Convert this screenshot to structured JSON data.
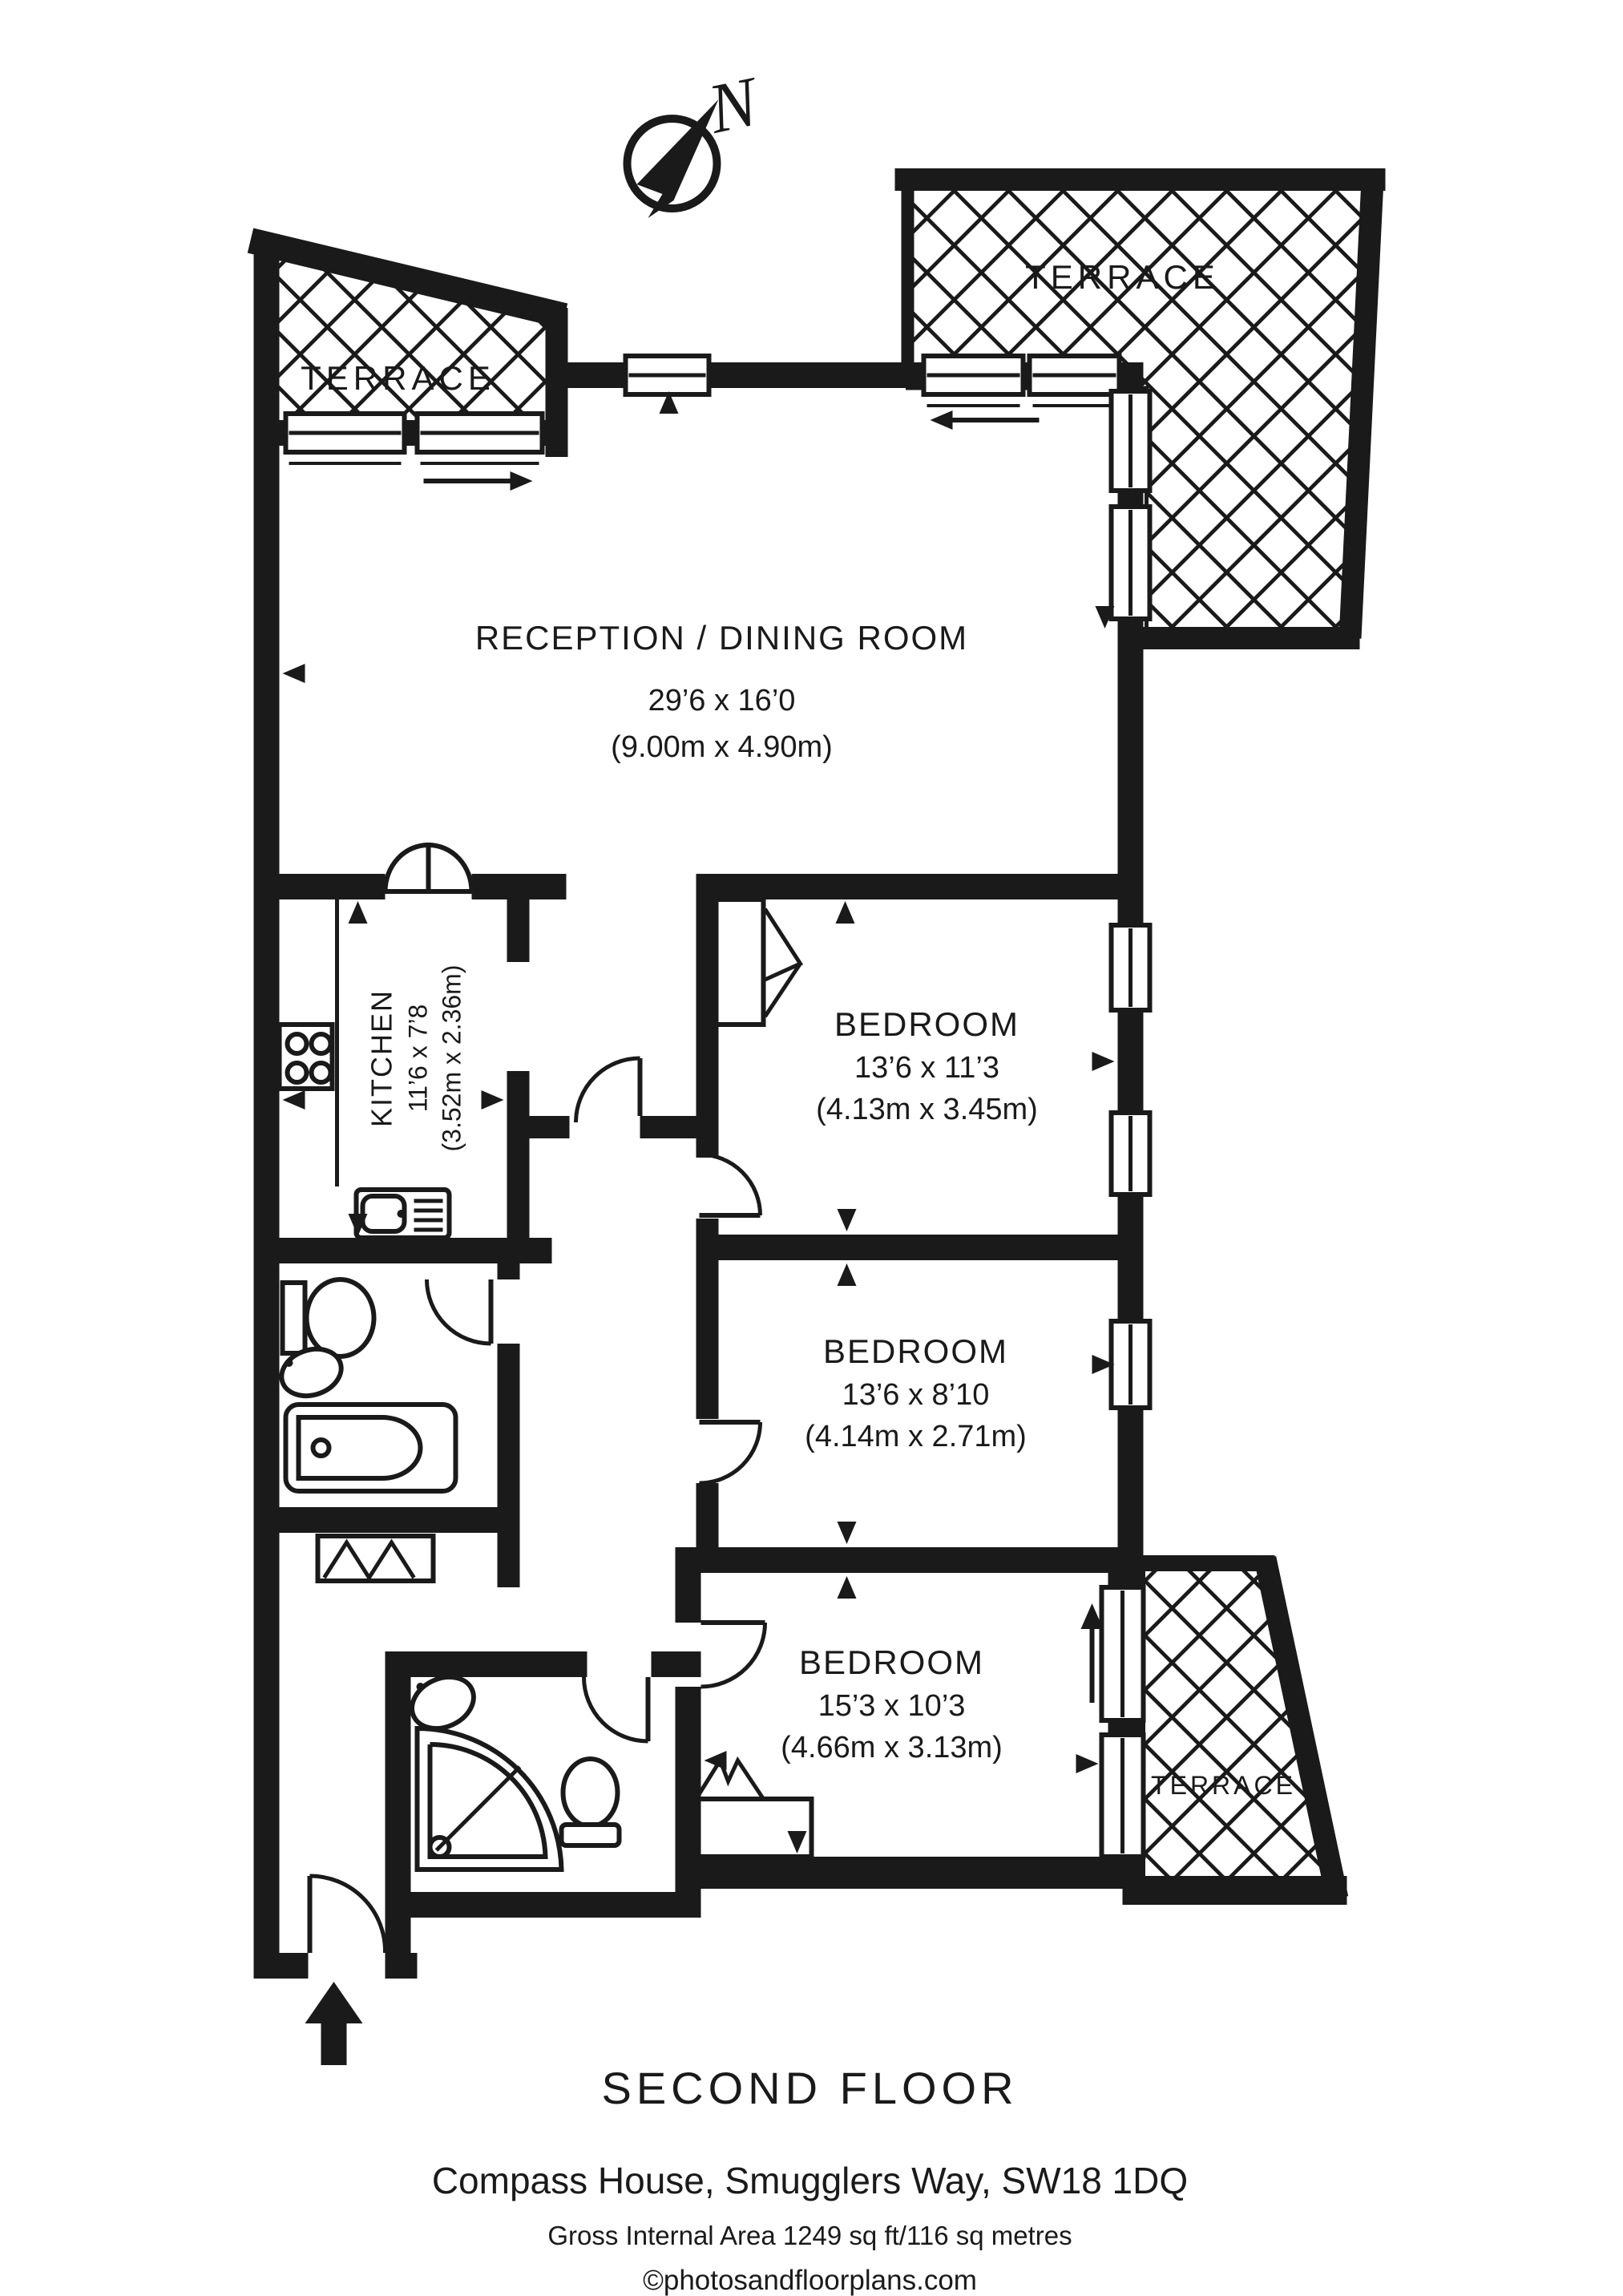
{
  "compass": {
    "label": "N"
  },
  "terraces": {
    "top_left": "TERRACE",
    "top_right": "TERRACE",
    "bottom_right": "TERRACE"
  },
  "rooms": {
    "reception": {
      "name": "RECEPTION / DINING ROOM",
      "imperial": "29’6 x 16’0",
      "metric": "(9.00m x 4.90m)"
    },
    "kitchen": {
      "name": "KITCHEN",
      "imperial": "11’6 x 7’8",
      "metric": "(3.52m x 2.36m)"
    },
    "bedroom1": {
      "name": "BEDROOM",
      "imperial": "13’6 x 11’3",
      "metric": "(4.13m x 3.45m)"
    },
    "bedroom2": {
      "name": "BEDROOM",
      "imperial": "13’6 x 8’10",
      "metric": "(4.14m x 2.71m)"
    },
    "bedroom3": {
      "name": "BEDROOM",
      "imperial": "15’3 x 10’3",
      "metric": "(4.66m x 3.13m)"
    }
  },
  "footer": {
    "floor": "SECOND FLOOR",
    "address": "Compass House, Smugglers Way, SW18 1DQ",
    "area": "Gross Internal Area 1249 sq ft/116 sq metres",
    "copyright": "©photosandfloorplans.com"
  }
}
